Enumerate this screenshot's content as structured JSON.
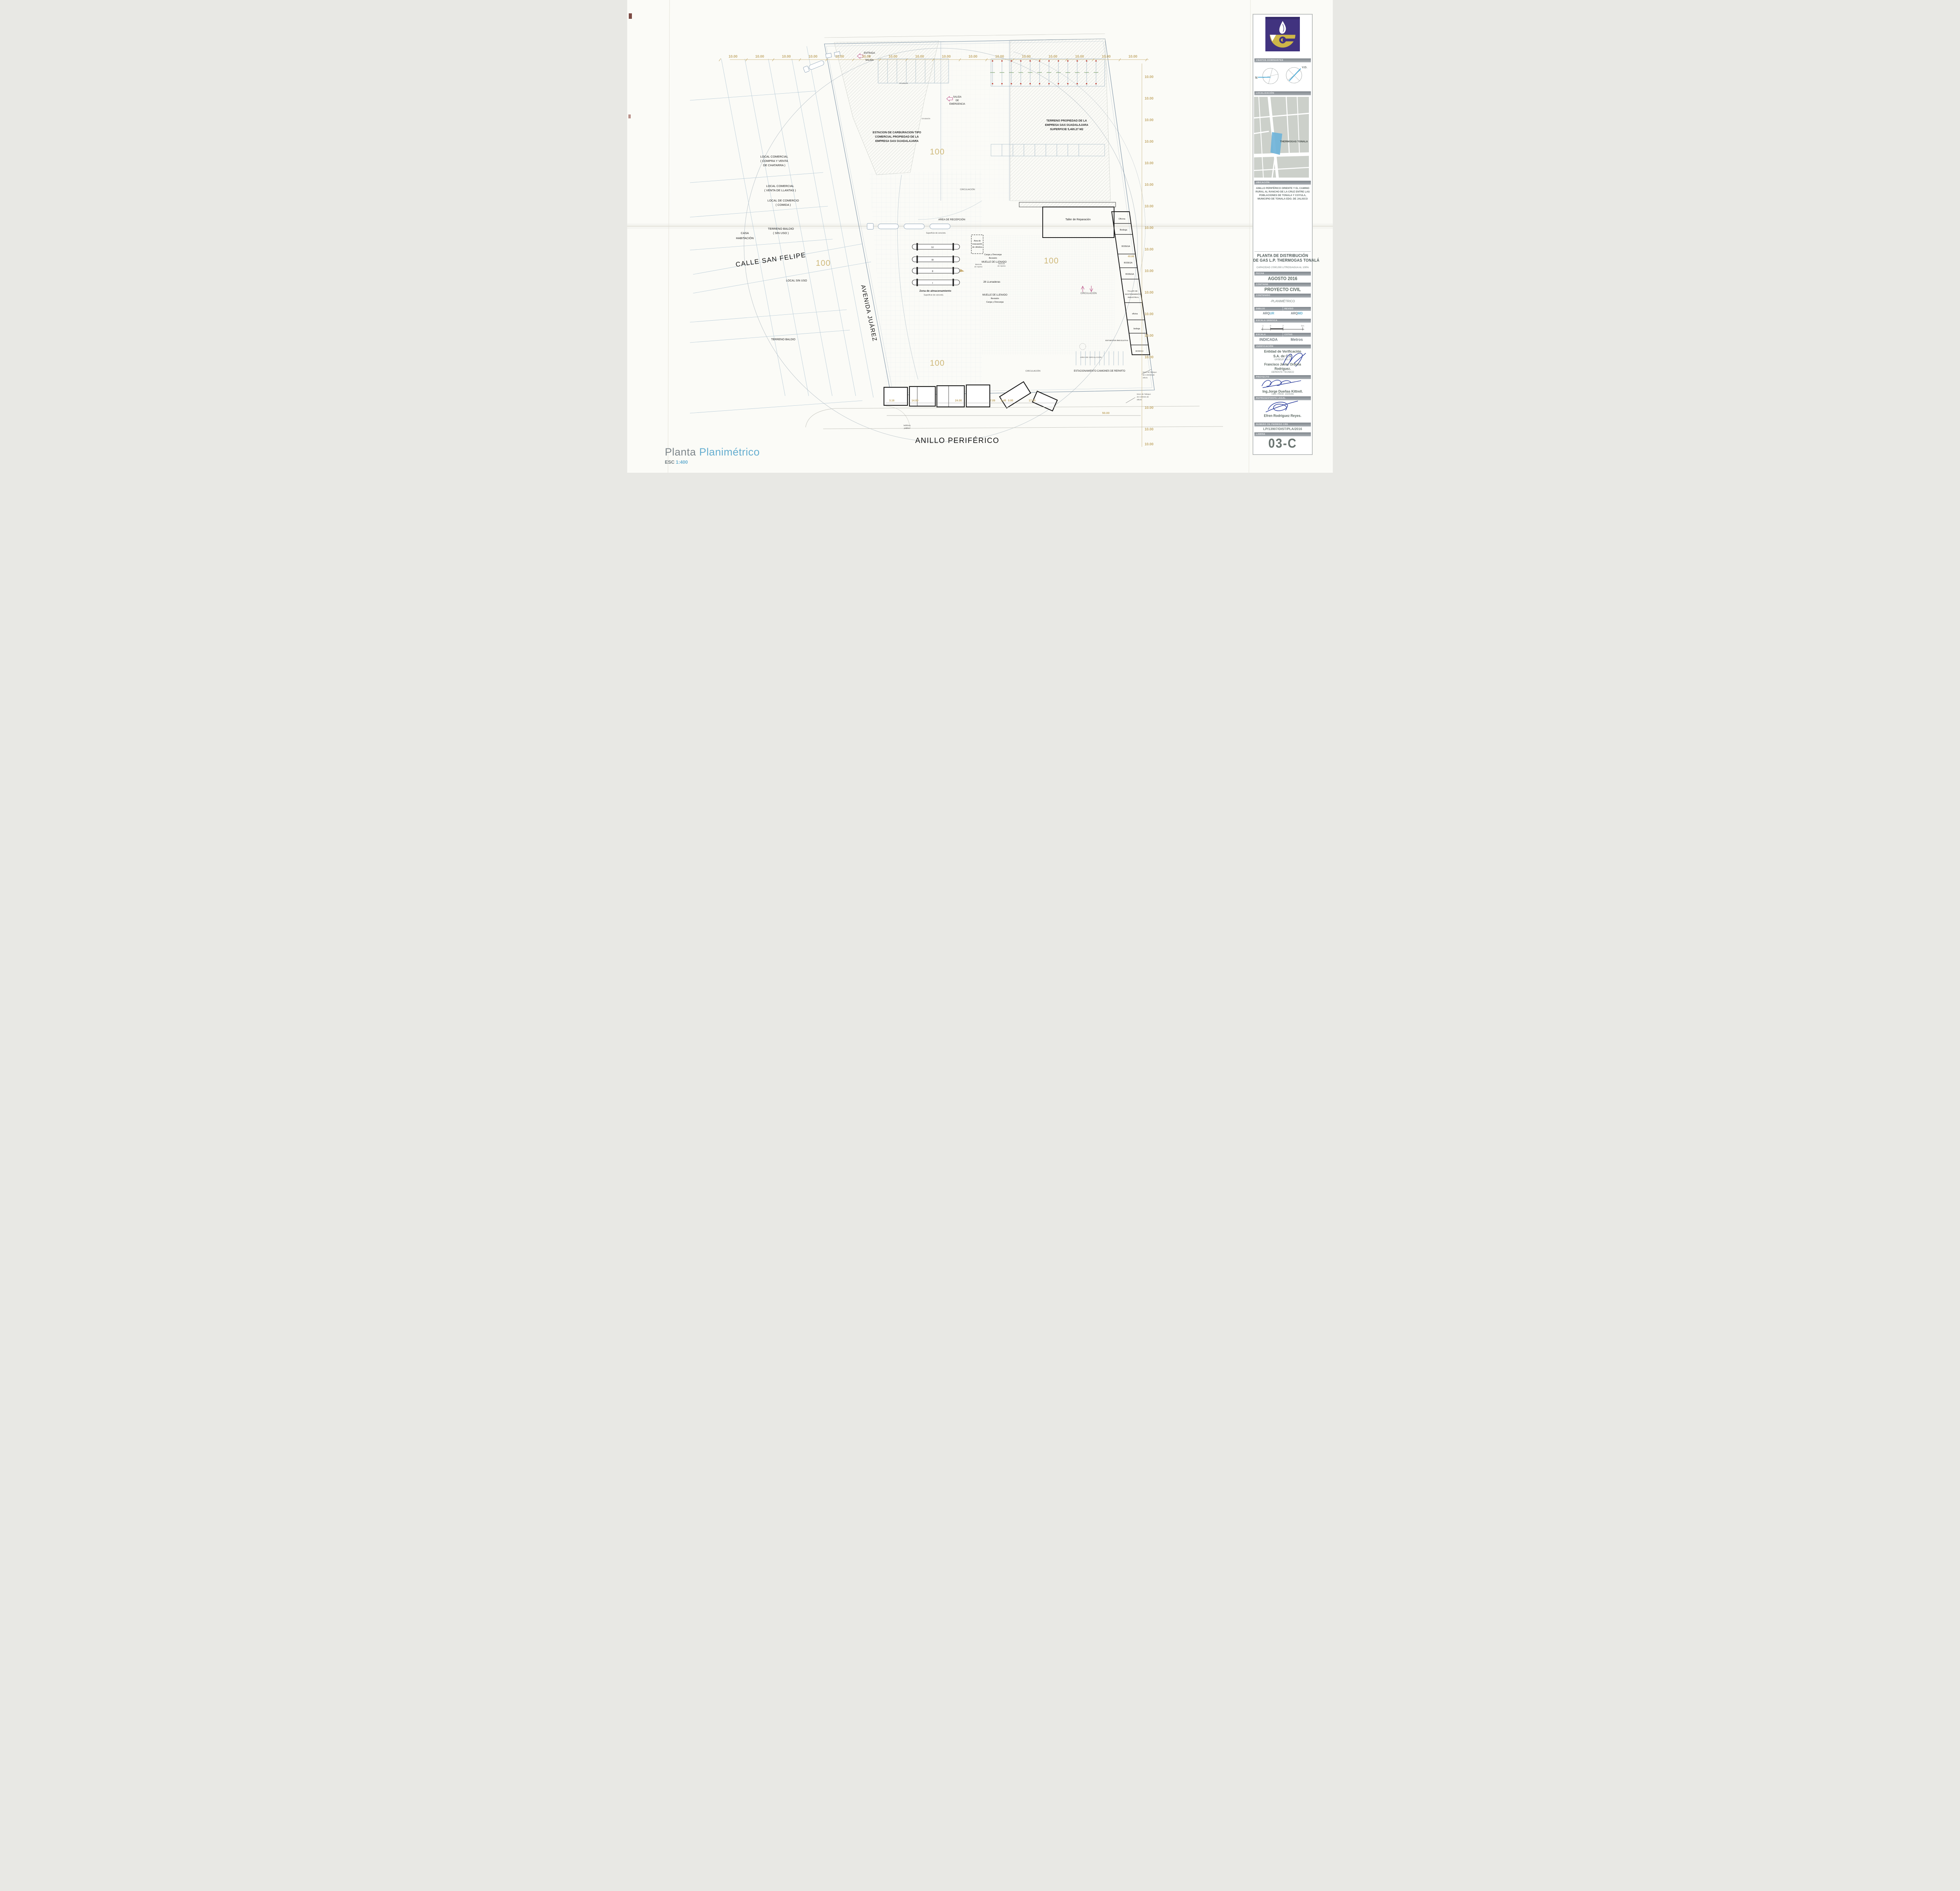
{
  "footer": {
    "title_gray": "Planta",
    "title_blue": "Planimétrico",
    "esc_label": "ESC",
    "esc_value": "1:400"
  },
  "title_block": {
    "vientos": "VIENTOS DOMINANTES",
    "north_label": "N",
    "vd_label": "V.D.",
    "localizacion": "LOCALIZACIÓN",
    "map_site_label": "THERMOGAS TONALA",
    "ubicacion": "UBICACIÓN",
    "address_lines": [
      "ANILLO PERIFÉRICO ORIENTE Y EL CAMINO",
      "RURAL AL RANCHO DE LA CRUZ ENTRE LAS",
      "POBLACIONES DE TONALA Y COYULA,",
      "MUNICIPIO DE TONALA EDO. DE JALISCO"
    ],
    "title_line1": "PLANTA DE DISTRIBUCIÓN",
    "title_line2": "DE GAS L.P. THERMOGAS TONALÁ",
    "capacity": "CAPACIDAD 1'000,000 LITROS/AGUA AL 100%",
    "fecha_label": "FECHA",
    "fecha_value": "AGOSTO 2016",
    "contiene_label": "CONTIENE",
    "contiene_value": "PROYECTO CIVIL",
    "contenido_label": "CONTENIDO",
    "contenido_value": "-PLANIMÉTRICO",
    "dibujo_label": "DIBUJO",
    "reviso_label": "REVISO",
    "arq_prefix": "ARQ",
    "dibujo_initials": "UR",
    "reviso_initials": "MD",
    "escala_grafica_label": "ESCALA GRÁFICA",
    "scale_ticks": [
      "-1",
      "0",
      "2",
      "5m"
    ],
    "escala_label": "ESCALA",
    "cotas_label": "COTAS",
    "escala_value": "INDICADA",
    "cotas_value": "Metros",
    "verificacion_label": "VERIFICACIÓN",
    "verif_line1": "Entidad de Verificación",
    "verif_line2": "S.A. de C.V.",
    "verif_reg": "UVSELP 191-C",
    "gerente_line1": "Francisco Javier Orduña",
    "gerente_line2": "Rodríguez.",
    "gerente_role": "GERENTE TECNICO",
    "proyecto_label": "PROYECTO",
    "proyecto_name": "Ing.Jorge Dueñas Kittrell.",
    "proyecto_ced": "CED. PROF. 1024155",
    "rep_label": "REPRESENTANTE LEGAL",
    "rep_name": "Efren Rodríguez Reyes.",
    "permiso_label": "NUMERO DE PERMISO CRE",
    "permiso_value": "LP/13907/DIST/PLA/2016",
    "lamina_label": "LAMINA",
    "lamina_value": "03-C"
  },
  "plan": {
    "streets": {
      "calle": "CALLE SAN FELIPE",
      "avenida": "AVENIDA JUÁREZ",
      "anillo": "ANILLO PERIFÉRICO"
    },
    "parcels": {
      "chatarra": [
        "LOCAL COMERCIAL",
        "( COMPRA Y VENTA",
        "DE CHATARRA )"
      ],
      "llantas": [
        "LOCAL COMERCIAL",
        "( VENTA DE LLANTAS )"
      ],
      "comida": [
        "LOCAL DE COMERCIO",
        "(      COMIDA      )"
      ],
      "casa": [
        "CASA",
        "HABITACIÓN"
      ],
      "baldio_sin_uso": [
        "TERRENO BALDIO",
        "(      SIN USO )"
      ],
      "local_sin_uso": "LOCAL SIN USO",
      "terreno_baldio": "TERRENO BALDIO"
    },
    "site": {
      "estacion": [
        "ESTACION DE CARBURACION TIPO",
        "COMERCIAL PROPIEDAD DE LA",
        "EMPRESA GAS GUADALAJARA"
      ],
      "terreno": [
        "TERRENO PROPIEDAD DE LA",
        "EMPRESA GAS GUADALAJARA",
        "SUPERFICIE 5,465.27 M2"
      ],
      "entrada": [
        "ENTRADA",
        "Y",
        "SALIDA"
      ],
      "salida_emergencia": [
        "SALIDA",
        "DE",
        "EMERGENCIA"
      ],
      "area_recepcion": "AREA DE RECEPCIÓN",
      "superficie_concreto": "Superficie de concreto.",
      "zona_almacenamiento": "Zona de almacenamiento",
      "tanques": [
        "IV",
        "III",
        "II",
        "I"
      ],
      "area_evacuacion": [
        "Area de",
        "evacuación",
        "de cilindros"
      ],
      "carga_descarga": "Carga y Descarga",
      "revision": "Revisión",
      "muelle": "MUELLE DE LLENADO",
      "bascula": [
        "Bascula",
        "de repeso"
      ],
      "llenaderas": "28 LLenaderas",
      "taller_reparacion": "Taller de Reparación",
      "oficina": "Oficina",
      "bodega": "Bodega",
      "bodega_caps": "BODEGA",
      "taller_mantenimiento": [
        "TALLER DE",
        "MANTENIMIENTO",
        "INDUSTRIAL"
      ],
      "oficina_min": "oficina",
      "bodega_min": "bodega",
      "est_motos": "EST.MOTOS /BICICLETAS",
      "circulacion": "CIRCULACIÓN",
      "circulacion_min": "Circulación",
      "area_circulacion": "AREA DE CIRCULACIÓN",
      "estacionamiento": "ESTACIONAMIENTO CAMIONES DE REPARTO",
      "muro": [
        "Muro de Tabique",
        "de 3.00mts de",
        "altura."
      ],
      "telefono": [
        "teléfono",
        "público"
      ]
    },
    "dims": {
      "d10": "10.00",
      "d50": "50.00",
      "d4986": "49.86",
      "marker100": "100",
      "bottom": [
        "3.16",
        "14.80",
        "24.00",
        "7.09",
        "2.45",
        "0.95",
        "17.35"
      ]
    }
  }
}
